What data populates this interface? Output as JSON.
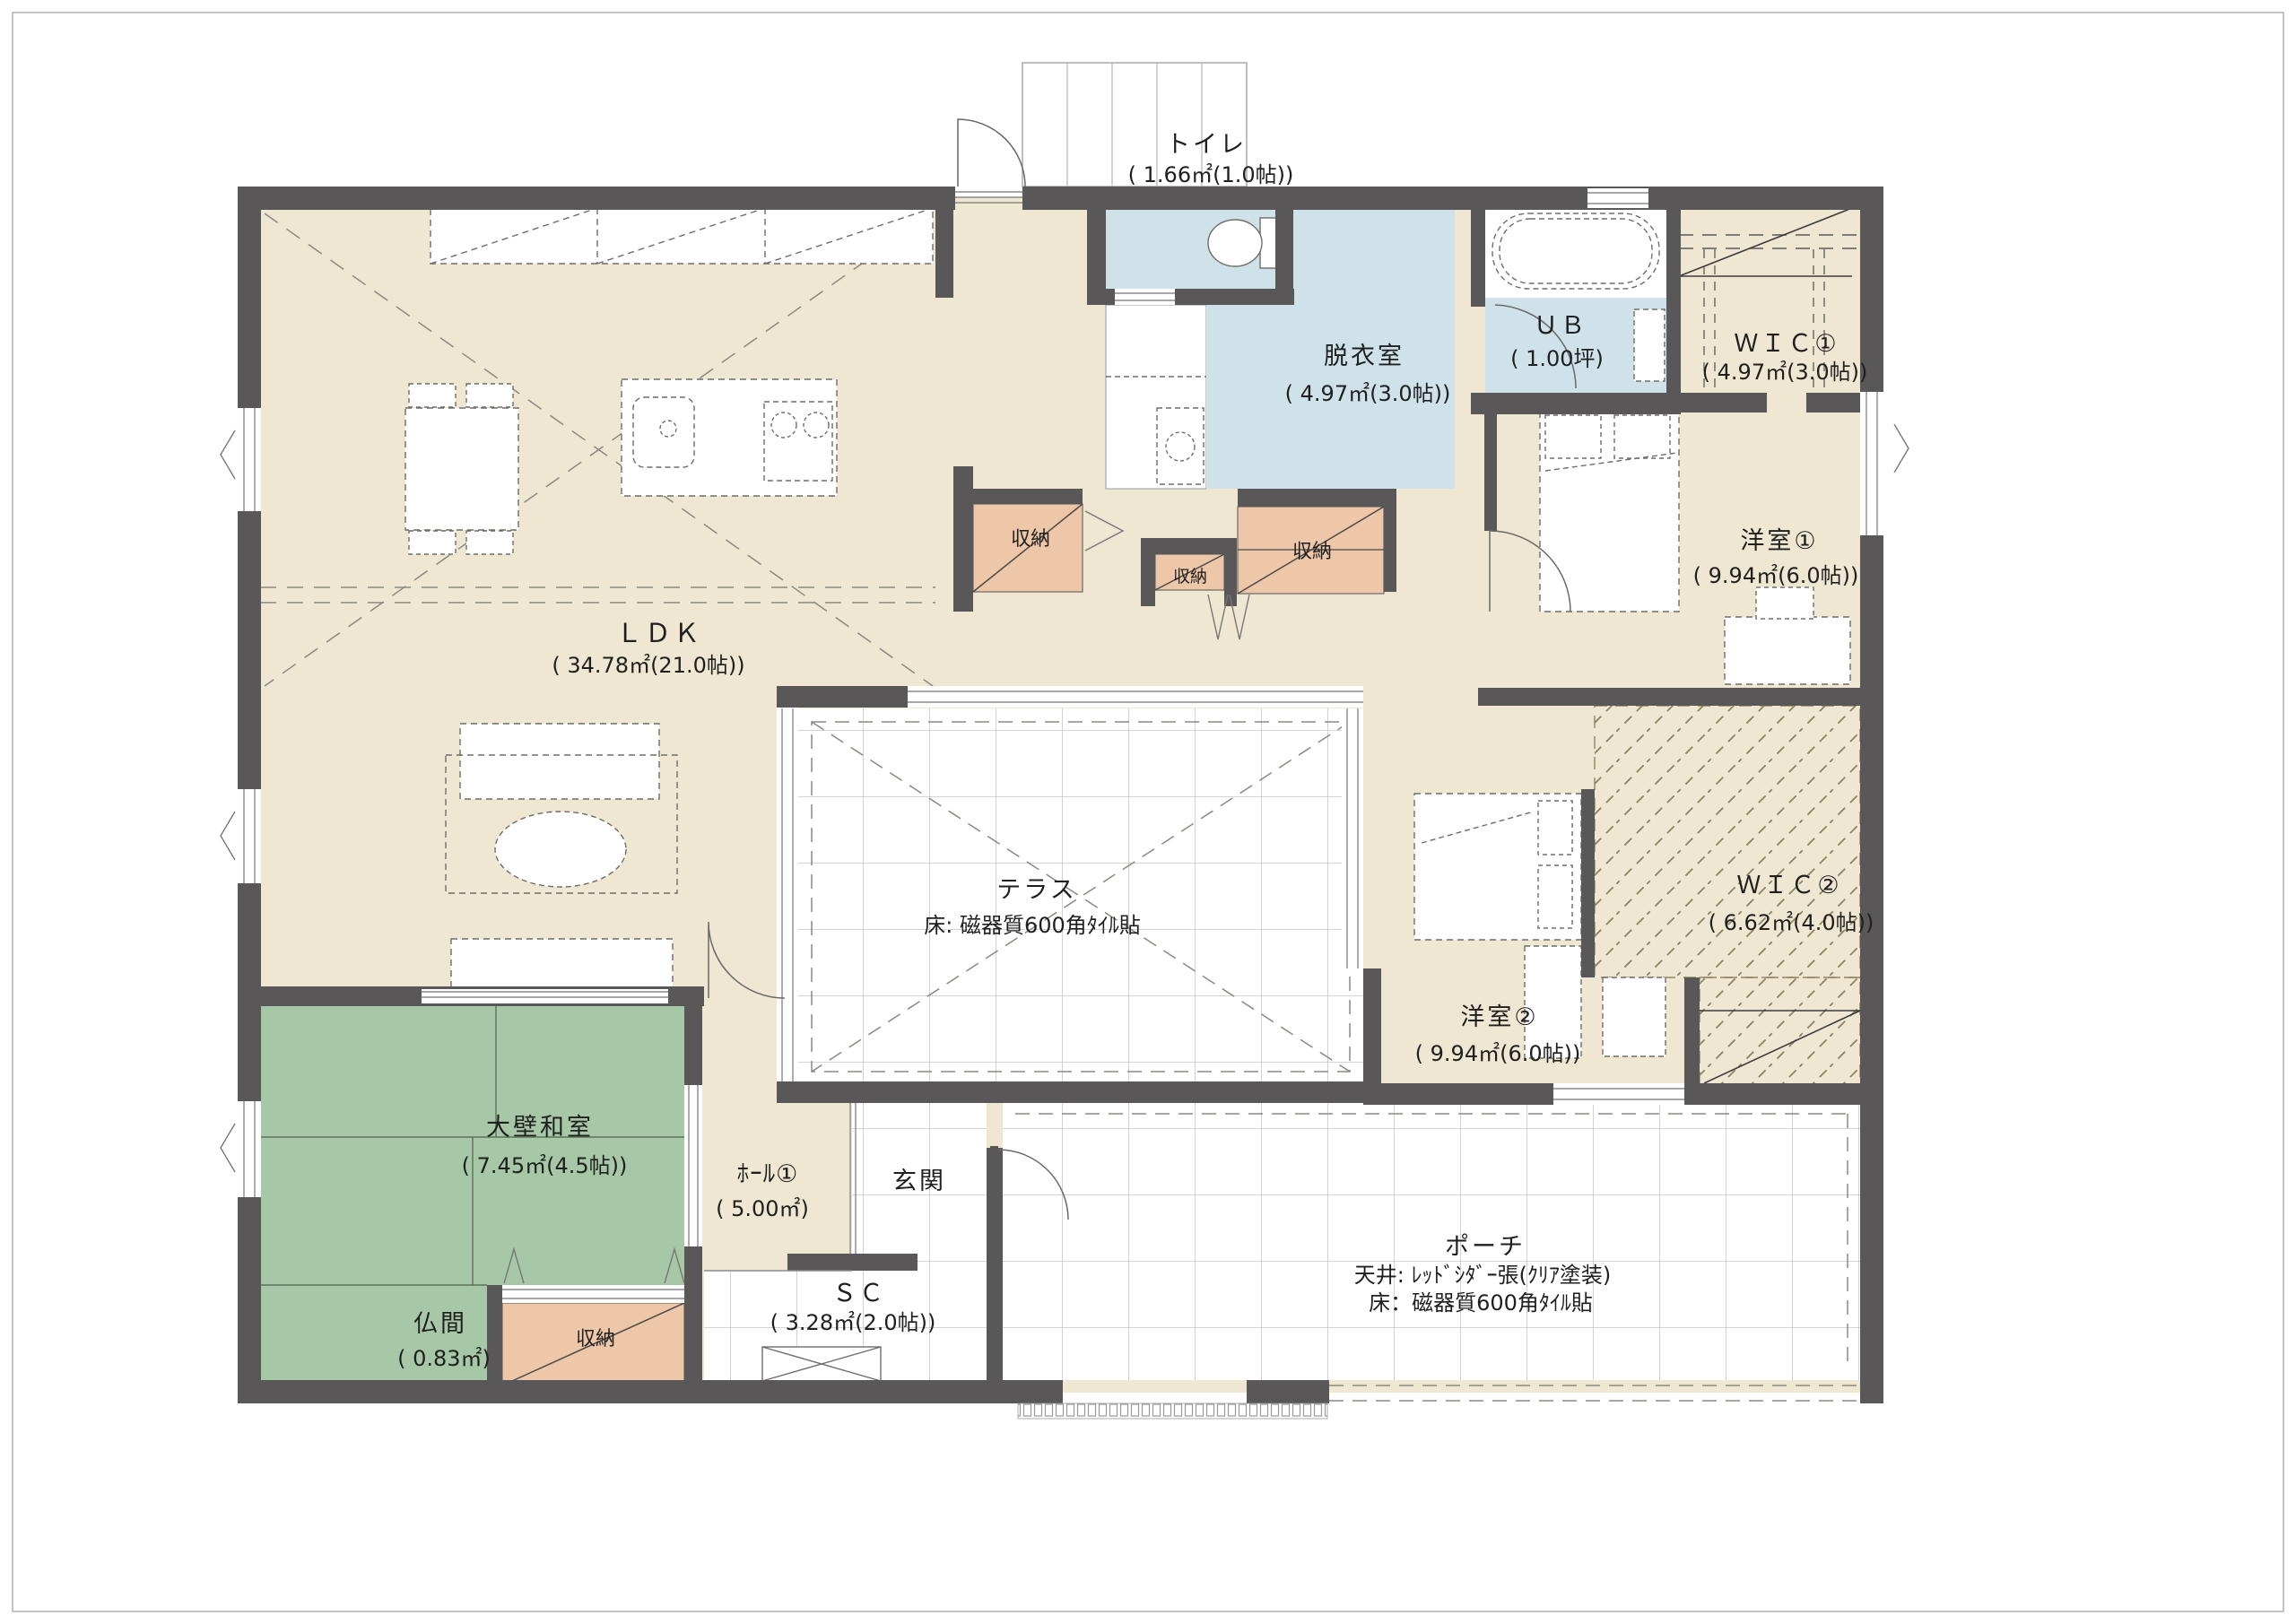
{
  "colors": {
    "wall": "#595757",
    "floor_beige": "#efe7d2",
    "water_blue": "#cfe2ea",
    "tatami_green": "#a7c8a6",
    "storage_peach": "#eec7a8",
    "hatch_line": "#8d8463"
  },
  "rooms": {
    "ldk": {
      "name": "ＬＤＫ",
      "area": "( 34.78㎡(21.0帖))"
    },
    "toilet": {
      "name": "トイレ",
      "area": "( 1.66㎡(1.0帖))"
    },
    "datsuishitsu": {
      "name": "脱衣室",
      "area": "( 4.97㎡(3.0帖))"
    },
    "ub": {
      "name": "ＵＢ",
      "area": "( 1.00坪)"
    },
    "wic1": {
      "name": "ＷＩＣ①",
      "area": "( 4.97㎡(3.0帖))"
    },
    "yoshitsu1": {
      "name": "洋室①",
      "area": "( 9.94㎡(6.0帖))"
    },
    "terrace": {
      "name": "テラス",
      "floor": "床: 磁器質600角ﾀｲﾙ貼"
    },
    "wic2": {
      "name": "ＷＩＣ②",
      "area": "( 6.62㎡(4.0帖))"
    },
    "yoshitsu2": {
      "name": "洋室②",
      "area": "( 9.94㎡(6.0帖))"
    },
    "washitsu": {
      "name": "大壁和室",
      "area": "( 7.45㎡(4.5帖))"
    },
    "butsuma": {
      "name": "仏間",
      "area": "( 0.83㎡)"
    },
    "hall1": {
      "name": "ﾎｰﾙ①",
      "area": "( 5.00㎡)"
    },
    "genkan": {
      "name": "玄関"
    },
    "sc": {
      "name": "ＳＣ",
      "area": "( 3.28㎡(2.0帖))"
    },
    "porch": {
      "name": "ポーチ",
      "ceiling": "天井: ﾚｯﾄﾞｼﾀﾞｰ張(ｸﾘｱ塗装)",
      "floor": "床：磁器質600角ﾀｲﾙ貼"
    }
  },
  "labels": {
    "storage": "収納"
  }
}
